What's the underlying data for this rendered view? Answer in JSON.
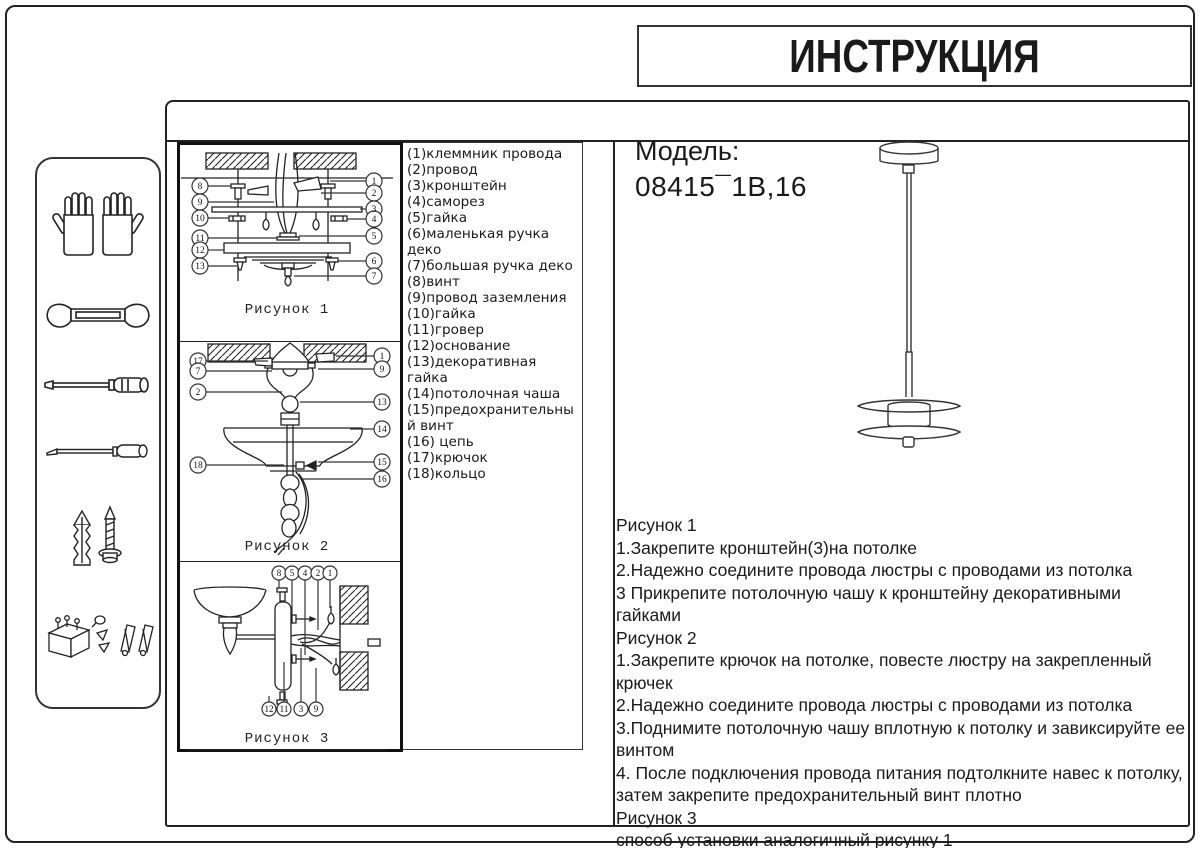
{
  "header": {
    "title": "ИНСТРУКЦИЯ"
  },
  "model": {
    "label": "Модель:",
    "number": "08415¯1B,16"
  },
  "parts": {
    "items": [
      "(1)клеммник провода",
      "(2)провод",
      "(3)кронштейн",
      "(4)саморез",
      "(5)гайка",
      "(6)маленькая ручка деко",
      "(7)большая ручка деко",
      "(8)винт",
      "(9)провод заземления",
      "(10)гайка",
      "(11)гровер",
      "(12)основание",
      "(13)декоративная гайка",
      "(14)потолочная чаша",
      "(15)предохранительный винт",
      "(16) цепь",
      "(17)крючок",
      "(18)кольцо"
    ]
  },
  "figures": {
    "fig1": {
      "label": "Рисунок 1",
      "callouts_left": [
        "8",
        "9",
        "10",
        "11",
        "12",
        "13"
      ],
      "callouts_right": [
        "1",
        "2",
        "3",
        "4",
        "5",
        "6",
        "7"
      ]
    },
    "fig2": {
      "label": "Рисунок 2",
      "callouts_left": [
        "17",
        "7",
        "2",
        "18"
      ],
      "callouts_right": [
        "1",
        "9",
        "13",
        "14",
        "15",
        "16"
      ]
    },
    "fig3": {
      "label": "Рисунок 3",
      "callouts_top": [
        "8",
        "5",
        "4",
        "2",
        "1"
      ],
      "callouts_bottom": [
        "12",
        "11",
        "3",
        "9"
      ]
    }
  },
  "instructions": {
    "lines": [
      "Рисунок 1",
      "1.Закрепите кронштейн(3)на потолке",
      "2.Надежно соедините провода люстры с проводами из потолка",
      "3 Прикрепите потолочную чашу к кронштейну декоративными гайками",
      "Рисунок 2",
      "1.Закрепите крючок на потолке, повесте люстру на закрепленный крючек",
      "2.Надежно соедините провода люстры с проводами из потолка",
      "3.Поднимите потолочную чашу вплотную к потолку и завиксируйте ее винтом",
      "4.  После подключения провода питания подтолкните навес к потолку, затем закрепите предохранительный винт плотно",
      "Рисунок 3",
      "способ установки аналогичный рисунку 1"
    ]
  },
  "sidebar": {
    "icons": [
      "gloves-icon",
      "wrench-icon",
      "screwdriver-icon",
      "awl-icon",
      "anchor-screw-icon",
      "small-parts-icon"
    ]
  },
  "colors": {
    "ink": "#1a1a1a",
    "background": "#ffffff"
  }
}
